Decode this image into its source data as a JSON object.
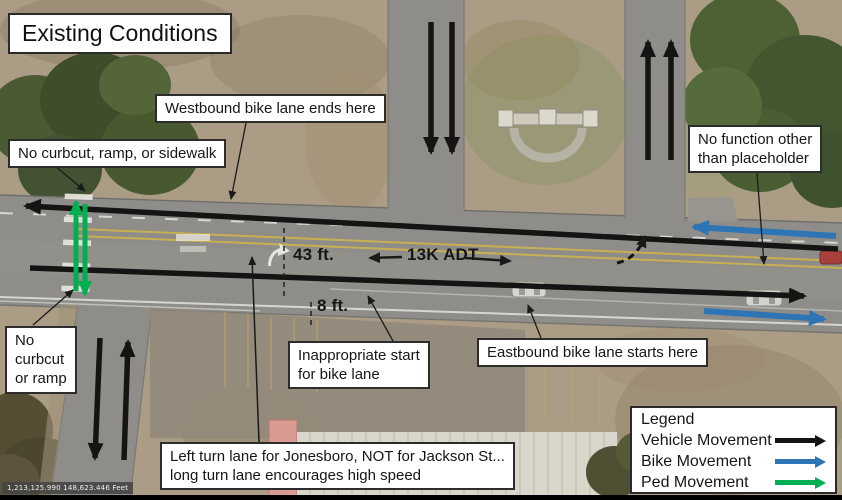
{
  "title": "Existing Conditions",
  "callouts": {
    "westbound_bike_ends": "Westbound bike lane ends here",
    "no_curbcut_sidewalk": "No curbcut, ramp, or sidewalk",
    "no_function": "No function other\nthan placeholder",
    "no_curbcut_ramp": "No\ncurbcut\nor ramp",
    "inappropriate_start": "Inappropriate start\nfor bike lane",
    "eastbound_bike_starts": "Eastbound bike lane starts here",
    "left_turn_note": "Left turn lane for Jonesboro, NOT for Jackson St...\nlong turn lane encourages high speed"
  },
  "measurements": {
    "road_width": "43 ft.",
    "bike_lane_width": "8 ft.",
    "traffic_volume": "13K ADT"
  },
  "legend": {
    "title": "Legend",
    "items": [
      {
        "label": "Vehicle Movement",
        "color": "#141414"
      },
      {
        "label": "Bike Movement",
        "color": "#2e75b6"
      },
      {
        "label": "Ped Movement",
        "color": "#00b050"
      }
    ]
  },
  "status_bar": {
    "coordinates": "1,213,125.990 148,623.446 Feet"
  },
  "colors": {
    "vehicle": "#141414",
    "bike": "#2e75b6",
    "ped": "#00b050"
  }
}
